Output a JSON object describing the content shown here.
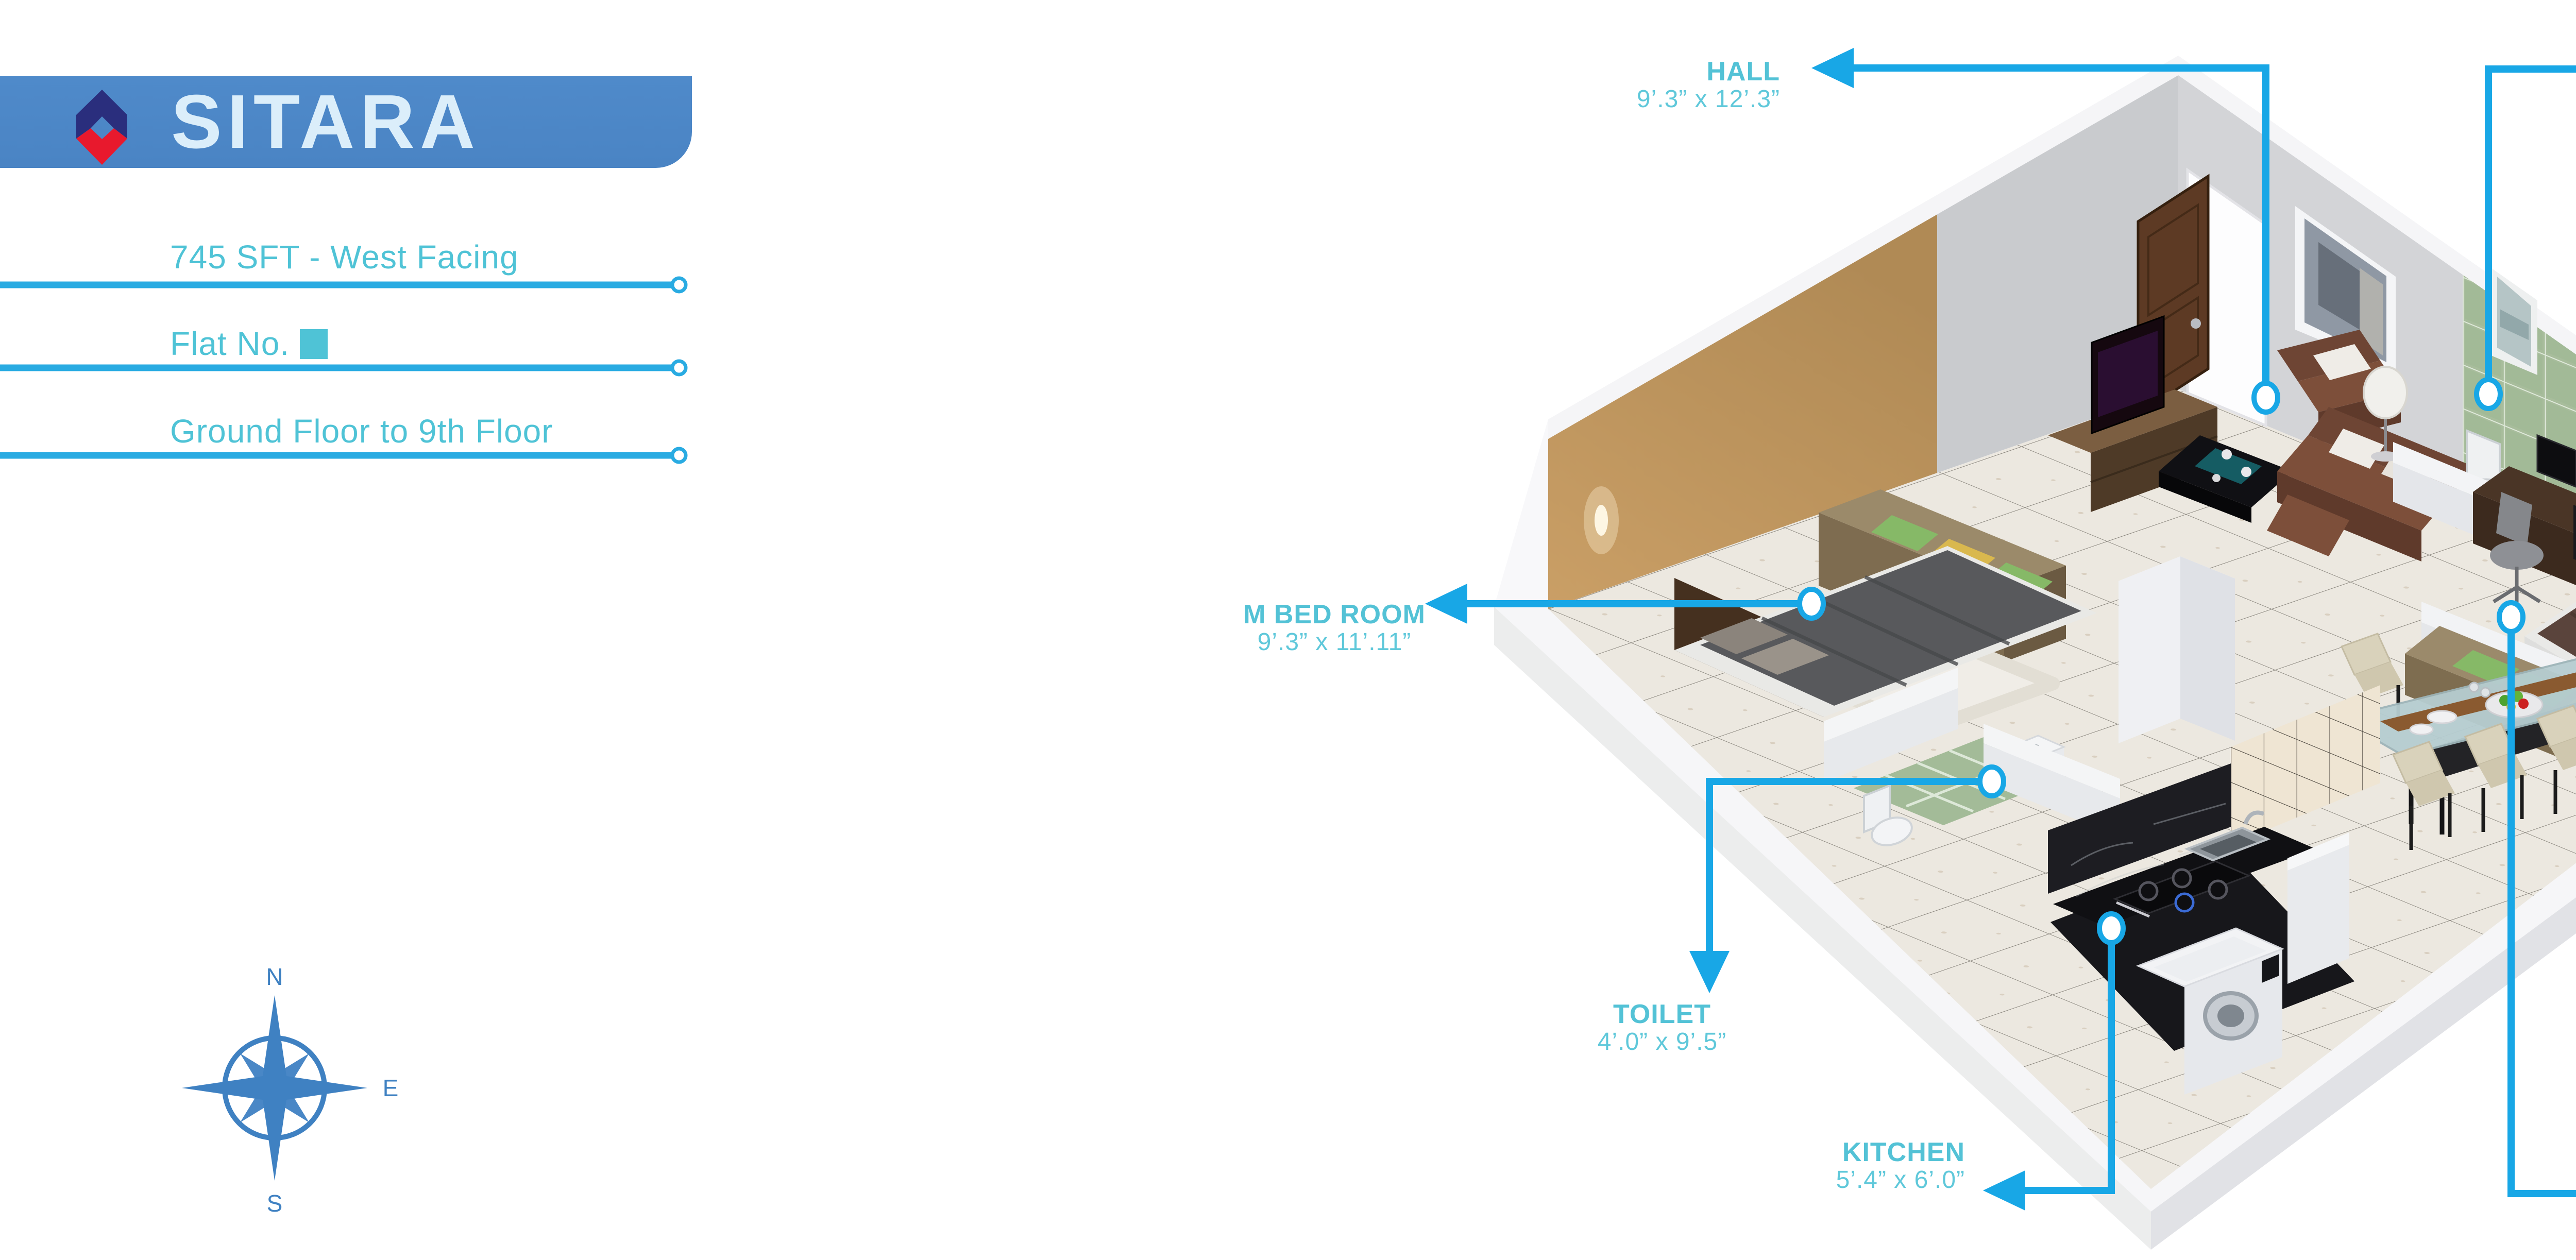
{
  "brand": {
    "name": "SITARA"
  },
  "info": {
    "line1": "745 SFT - West Facing",
    "line2_prefix": "Flat No.",
    "line3": "Ground Floor to 9th Floor"
  },
  "compass": {
    "north": "N",
    "east": "E",
    "south": "S"
  },
  "labels": {
    "hall": {
      "name": "HALL",
      "dims": "9’.3” x 12’.3”"
    },
    "toilet_top": {
      "name": "TOILET",
      "dims": "4’.0” x 6’.3”"
    },
    "m_bedroom": {
      "name": "M BED ROOM",
      "dims": "9’.3” x 11’.11”"
    },
    "toilet_bottom": {
      "name": "TOILET",
      "dims": "4’.0” x 9’.5”"
    },
    "kitchen": {
      "name": "KITCHEN",
      "dims": "5’.4” x 6’.0”"
    },
    "c_bedroom": {
      "name": "C BED ROOM",
      "dims": "9’.10” x 8’.11”"
    },
    "dining": {
      "name": "DINING",
      "dims": "13’.1” x 9’.2”"
    }
  },
  "colors": {
    "leader_line": "#18a7e6",
    "label_text": "#53c2d6",
    "info_text": "#4fc3d6",
    "rule_line": "#29abe2",
    "banner_blue": "#4b86c6",
    "logo_navy": "#2a2e7d",
    "logo_red": "#e8192d",
    "title_text": "#dbeefa",
    "compass_blue": "#3f81c2"
  }
}
